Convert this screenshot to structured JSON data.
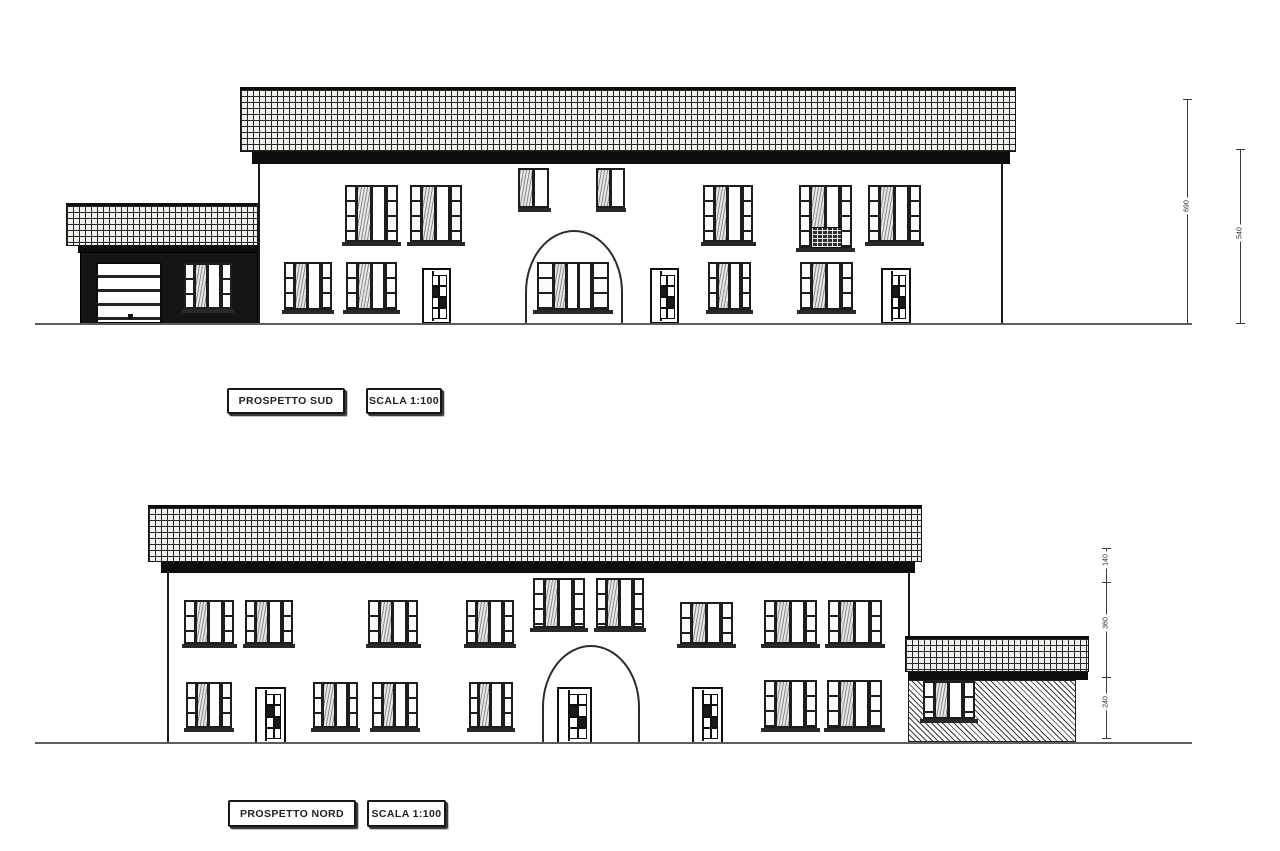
{
  "sheet": {
    "width": 1280,
    "height": 851,
    "background": "#ffffff"
  },
  "colors": {
    "paper": "#ffffff",
    "ink": "#1a1a1a",
    "ground_line": "#5d5d5d",
    "tile_fill": "#f1f0ec"
  },
  "drawings": [
    {
      "name": "south-elevation",
      "title": "PROSPETTO SUD",
      "scale": "SCALA 1:100",
      "geometry": {
        "ground": {
          "x": 35,
          "y": 323,
          "w": 1157,
          "h": 2
        },
        "main_roof": {
          "x": 240,
          "y": 87,
          "w": 776,
          "h": 65
        },
        "main_eaves": {
          "x": 252,
          "y": 152,
          "w": 758,
          "h": 12
        },
        "main_wall": {
          "x": 258,
          "y": 163,
          "w": 745,
          "h": 161
        },
        "annex_roof": {
          "x": 66,
          "y": 203,
          "w": 192,
          "h": 43
        },
        "annex_eaves": {
          "x": 78,
          "y": 246,
          "w": 180,
          "h": 7
        },
        "annex_wall": {
          "x": 80,
          "y": 252,
          "w": 178,
          "h": 72
        },
        "annex_fill": "dark",
        "arch": {
          "x": 525,
          "y": 230,
          "w": 98,
          "h": 94
        }
      },
      "openings": [
        {
          "type": "garage-door",
          "x": 96,
          "y": 262,
          "w": 66,
          "h": 62
        },
        {
          "type": "window",
          "x": 184,
          "y": 263,
          "w": 48,
          "h": 46
        },
        {
          "type": "window",
          "x": 345,
          "y": 185,
          "w": 53,
          "h": 57
        },
        {
          "type": "window",
          "x": 410,
          "y": 185,
          "w": 52,
          "h": 57
        },
        {
          "type": "window-narrow",
          "x": 519,
          "y": 168,
          "w": 30,
          "h": 40
        },
        {
          "type": "window-narrow",
          "x": 597,
          "y": 168,
          "w": 28,
          "h": 40
        },
        {
          "type": "window",
          "x": 703,
          "y": 185,
          "w": 50,
          "h": 57
        },
        {
          "type": "balcony-door",
          "x": 799,
          "y": 185,
          "w": 53,
          "h": 63
        },
        {
          "type": "window",
          "x": 868,
          "y": 185,
          "w": 53,
          "h": 57
        },
        {
          "type": "window",
          "x": 284,
          "y": 262,
          "w": 48,
          "h": 48
        },
        {
          "type": "window",
          "x": 346,
          "y": 262,
          "w": 51,
          "h": 48
        },
        {
          "type": "door",
          "x": 422,
          "y": 268,
          "w": 29,
          "h": 56
        },
        {
          "type": "window-wide",
          "x": 537,
          "y": 262,
          "w": 72,
          "h": 48
        },
        {
          "type": "door",
          "x": 650,
          "y": 268,
          "w": 29,
          "h": 56
        },
        {
          "type": "window",
          "x": 708,
          "y": 262,
          "w": 43,
          "h": 48
        },
        {
          "type": "window",
          "x": 800,
          "y": 262,
          "w": 53,
          "h": 48
        },
        {
          "type": "door",
          "x": 881,
          "y": 268,
          "w": 30,
          "h": 56
        }
      ],
      "dimension_lines": [
        {
          "x": 1187,
          "y1": 99,
          "y2": 323,
          "ticks": [
            99,
            323
          ],
          "labels": [
            {
              "v": "690",
              "y": 210
            }
          ]
        },
        {
          "x": 1240,
          "y1": 149,
          "y2": 323,
          "ticks": [
            149,
            323
          ],
          "labels": [
            {
              "v": "540",
              "y": 237
            }
          ]
        }
      ]
    },
    {
      "name": "north-elevation",
      "title": "PROSPETTO NORD",
      "scale": "SCALA 1:100",
      "geometry": {
        "ground": {
          "x": 35,
          "y": 742,
          "w": 1157,
          "h": 2
        },
        "main_roof": {
          "x": 148,
          "y": 505,
          "w": 774,
          "h": 57
        },
        "main_eaves": {
          "x": 161,
          "y": 562,
          "w": 754,
          "h": 11
        },
        "main_wall": {
          "x": 167,
          "y": 573,
          "w": 743,
          "h": 169
        },
        "annex_roof": {
          "x": 905,
          "y": 636,
          "w": 184,
          "h": 36
        },
        "annex_eaves": {
          "x": 908,
          "y": 672,
          "w": 180,
          "h": 8
        },
        "annex_wall": {
          "x": 908,
          "y": 680,
          "w": 168,
          "h": 62
        },
        "annex_fill": "hatch",
        "arch": {
          "x": 542,
          "y": 645,
          "w": 98,
          "h": 97
        }
      },
      "openings": [
        {
          "type": "window",
          "x": 184,
          "y": 600,
          "w": 50,
          "h": 44
        },
        {
          "type": "window",
          "x": 245,
          "y": 600,
          "w": 48,
          "h": 44
        },
        {
          "type": "window",
          "x": 368,
          "y": 600,
          "w": 50,
          "h": 44
        },
        {
          "type": "window",
          "x": 466,
          "y": 600,
          "w": 48,
          "h": 44
        },
        {
          "type": "window",
          "x": 533,
          "y": 578,
          "w": 52,
          "h": 50
        },
        {
          "type": "window",
          "x": 596,
          "y": 578,
          "w": 48,
          "h": 50
        },
        {
          "type": "window",
          "x": 680,
          "y": 602,
          "w": 53,
          "h": 42
        },
        {
          "type": "window",
          "x": 764,
          "y": 600,
          "w": 53,
          "h": 44
        },
        {
          "type": "window",
          "x": 828,
          "y": 600,
          "w": 54,
          "h": 44
        },
        {
          "type": "window",
          "x": 186,
          "y": 682,
          "w": 46,
          "h": 46
        },
        {
          "type": "door",
          "x": 255,
          "y": 687,
          "w": 31,
          "h": 57
        },
        {
          "type": "window",
          "x": 313,
          "y": 682,
          "w": 45,
          "h": 46
        },
        {
          "type": "window",
          "x": 372,
          "y": 682,
          "w": 46,
          "h": 46
        },
        {
          "type": "window",
          "x": 469,
          "y": 682,
          "w": 44,
          "h": 46
        },
        {
          "type": "door",
          "x": 557,
          "y": 687,
          "w": 35,
          "h": 57
        },
        {
          "type": "door",
          "x": 692,
          "y": 687,
          "w": 31,
          "h": 57
        },
        {
          "type": "window",
          "x": 764,
          "y": 680,
          "w": 53,
          "h": 48
        },
        {
          "type": "window",
          "x": 827,
          "y": 680,
          "w": 55,
          "h": 48
        },
        {
          "type": "window",
          "x": 923,
          "y": 681,
          "w": 52,
          "h": 38
        }
      ],
      "dimension_lines": [
        {
          "x": 1106,
          "y1": 548,
          "y2": 738,
          "ticks": [
            548,
            582,
            677,
            738
          ],
          "labels": [
            {
              "v": "140",
              "y": 564
            },
            {
              "v": "360",
              "y": 627
            },
            {
              "v": "240",
              "y": 706
            }
          ]
        }
      ]
    }
  ]
}
